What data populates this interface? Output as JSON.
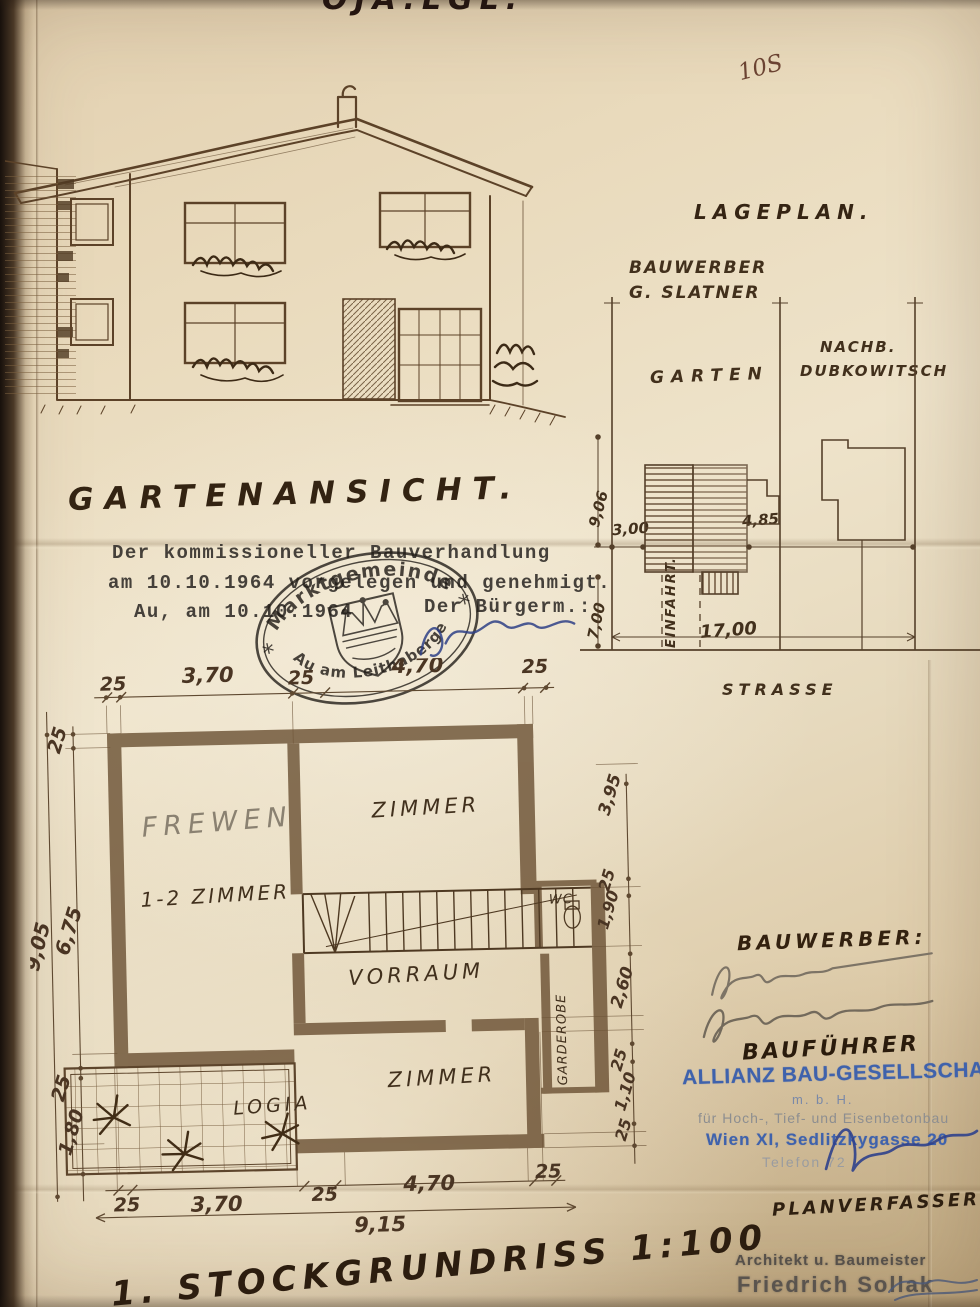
{
  "page": {
    "corner_note": "OJA.LGL.",
    "page_number": "10S"
  },
  "elevation": {
    "title": "GARTENANSICHT."
  },
  "approval": {
    "line1": "Der kommissioneller Bauverhandlung",
    "line2": "am 10.10.1964 vorgelegen und genehmigt.",
    "line3_left": "Au, am 10.10.1964",
    "line3_right": "Der Bürgerm.:"
  },
  "stamp": {
    "top_arc": "Marktgemeinde",
    "bottom_arc": "Au am Leithaberge",
    "star_left": "*",
    "star_right": "*"
  },
  "siteplan": {
    "title": "LAGEPLAN.",
    "bauwerber_label": "BAUWERBER",
    "bauwerber_name": "G. SLATNER",
    "garten": "GARTEN",
    "nachb_line1": "NACHB.",
    "nachb_line2": "DUBKOWITSCH",
    "strasse": "STRASSE",
    "einfahrt": "EINFAHRT.",
    "dim_depth_garden": "9,06",
    "dim_offset": "3,00",
    "dim_side": "4,85",
    "dim_front": "7,00",
    "dim_width": "17,00"
  },
  "floorplan": {
    "title": "1. STOCKGRUNDRISS 1:100",
    "room_frewen": "FREWEN",
    "room_12zimmer": "1-2 ZIMMER",
    "room_zimmer_top": "ZIMMER",
    "room_vorraum": "VORRAUM",
    "room_wc": "WC",
    "room_garderobe": "GARDEROBE",
    "room_zimmer_bottom": "ZIMMER",
    "room_logia": "LOGIA",
    "dims_top": [
      "25",
      "3,70",
      "25",
      "4,70",
      "25"
    ],
    "dim_left_total": "9,05",
    "dims_left": [
      "25",
      "6,75",
      "25",
      "1,80"
    ],
    "dims_right": [
      "3,95",
      "25",
      "1,90",
      "2,60",
      "25",
      "1,10",
      "25"
    ],
    "dims_bottom": [
      "25",
      "3,70",
      "25",
      "4,70",
      "25"
    ],
    "dim_bottom_total": "9,15"
  },
  "parties": {
    "bauwerber_label": "BAUWERBER:",
    "baufuehrer_label": "BAUFÜHRER",
    "company_name": "ALLIANZ BAU-GESELLSCHAFT",
    "company_mbh": "m. b. H.",
    "company_desc": "für Hoch-, Tief- und Eisenbetonbau",
    "company_addr": "Wien XI, Sedlitzkygasse 20",
    "company_tel": "Telefon 72",
    "planverfasser_label": "PLANVERFASSER:",
    "architect_line1": "Architekt u. Baumeister",
    "architect_line2": "Friedrich Sollak"
  }
}
